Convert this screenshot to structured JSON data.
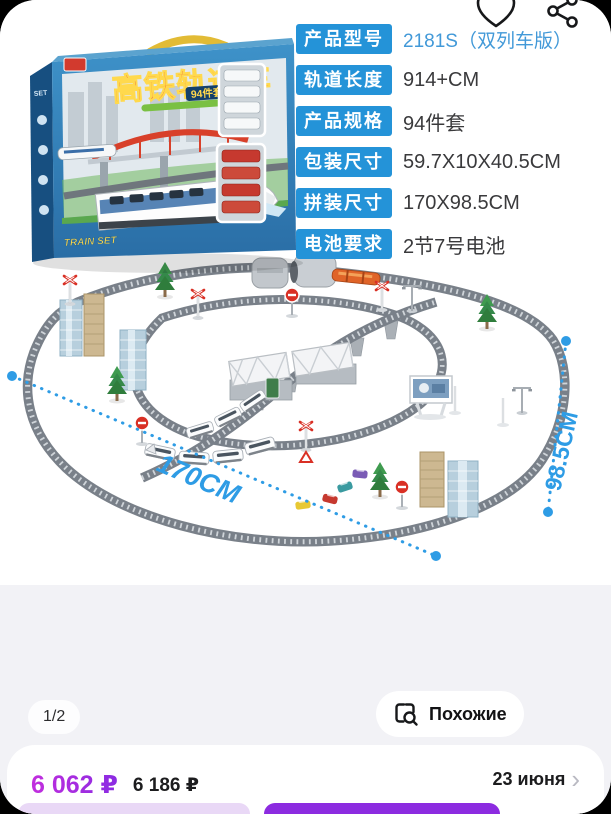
{
  "header": {
    "favorite_icon": "heart-icon",
    "share_icon": "share-icon"
  },
  "specs": {
    "rows": [
      {
        "label": "产品型号",
        "value": "2181S（双列车版）"
      },
      {
        "label": "轨道长度",
        "value": "914+CM"
      },
      {
        "label": "产品规格",
        "value": "94件套"
      },
      {
        "label": "包装尺寸",
        "value": "59.7X10X40.5CM"
      },
      {
        "label": "拼装尺寸",
        "value": "170X98.5CM"
      },
      {
        "label": "电池要求",
        "value": "2节7号电池"
      }
    ],
    "label_bg_color": "#2493d8",
    "highlight_value_color": "#4299d8"
  },
  "product_image": {
    "box_title": "高铁轨道车",
    "box_badge": "94件套",
    "box_side_text": "TRAIN SET",
    "dimension_width": "170CM",
    "dimension_height": "98.5CM",
    "dimension_color": "#2e9ce5"
  },
  "gallery": {
    "page_indicator": "1/2",
    "similar_button_label": "Похожие",
    "similar_button_icon": "search-similar-icon"
  },
  "price_bar": {
    "current_price": "6 062 ₽",
    "old_price": "6 186 ₽",
    "delivery_date": "23 июня",
    "chevron": "›",
    "current_price_color": "#9b2fe3"
  }
}
